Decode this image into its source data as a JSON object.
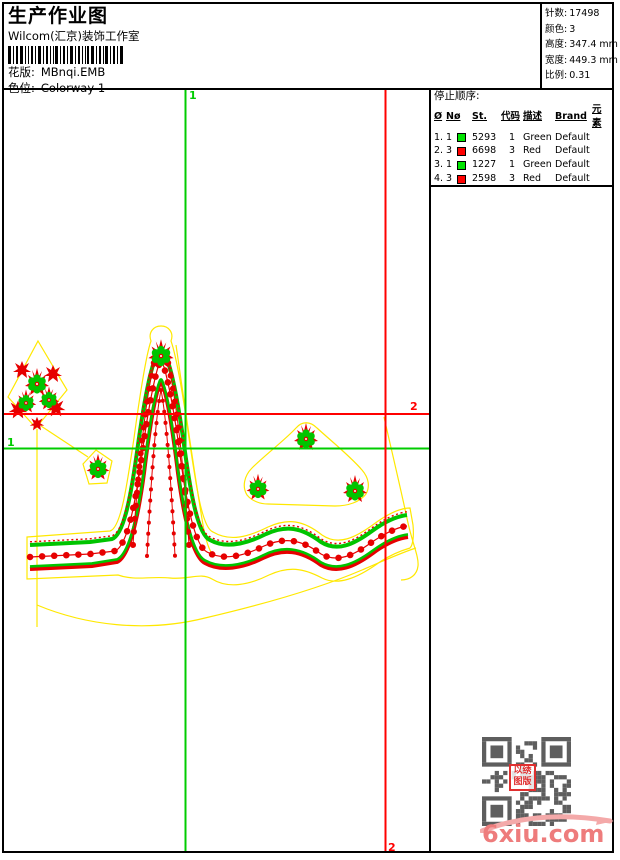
{
  "header": {
    "title": "生产作业图",
    "subtitle": "Wilcom(汇京)装饰工作室",
    "design": {
      "label": "花版:",
      "value": "MBnqi.EMB"
    },
    "colorway": {
      "label": "色位:",
      "value": "Colorway 1"
    },
    "stats": [
      {
        "label": "针数:",
        "value": "17498"
      },
      {
        "label": "颜色:",
        "value": "3"
      },
      {
        "label": "高度:",
        "value": "347.4 mm"
      },
      {
        "label": "宽度:",
        "value": "449.3 mm"
      },
      {
        "label": "比例:",
        "value": "0.31"
      }
    ]
  },
  "stop_sequence": {
    "title": "停止顺序:",
    "columns": {
      "hash": "Ø",
      "needle": "Nø",
      "stitches": "St.",
      "code": "代码",
      "description": "描述",
      "brand": "Brand",
      "element": "元素"
    },
    "rows": [
      {
        "no": "1.",
        "needle": "1",
        "color": "#00e400",
        "stitches": "5293",
        "code": "1",
        "description": "Green",
        "brand": "Default"
      },
      {
        "no": "2.",
        "needle": "3",
        "color": "#ff0000",
        "stitches": "6698",
        "code": "3",
        "description": "Red",
        "brand": "Default"
      },
      {
        "no": "3.",
        "needle": "1",
        "color": "#00e400",
        "stitches": "1227",
        "code": "1",
        "description": "Green",
        "brand": "Default"
      },
      {
        "no": "4.",
        "needle": "3",
        "color": "#ff0000",
        "stitches": "2598",
        "code": "3",
        "description": "Red",
        "brand": "Default"
      },
      {
        "no": "5.",
        "needle": "4",
        "color": "#ffff00",
        "stitches": "1680",
        "code": "4",
        "description": "Yellow",
        "brand": "Default"
      }
    ]
  },
  "canvas": {
    "guides": {
      "green_label": "1",
      "red_label": "2"
    }
  },
  "design_colors": {
    "stitch_green": "#00c400",
    "stitch_red": "#e60000",
    "outline_yellow": "#ffe800",
    "guide_green": "#00cc00",
    "guide_red": "#ff0000"
  },
  "watermark": {
    "site": "6xiu.com",
    "seal_line1": "以绣",
    "seal_line2": "图版"
  }
}
